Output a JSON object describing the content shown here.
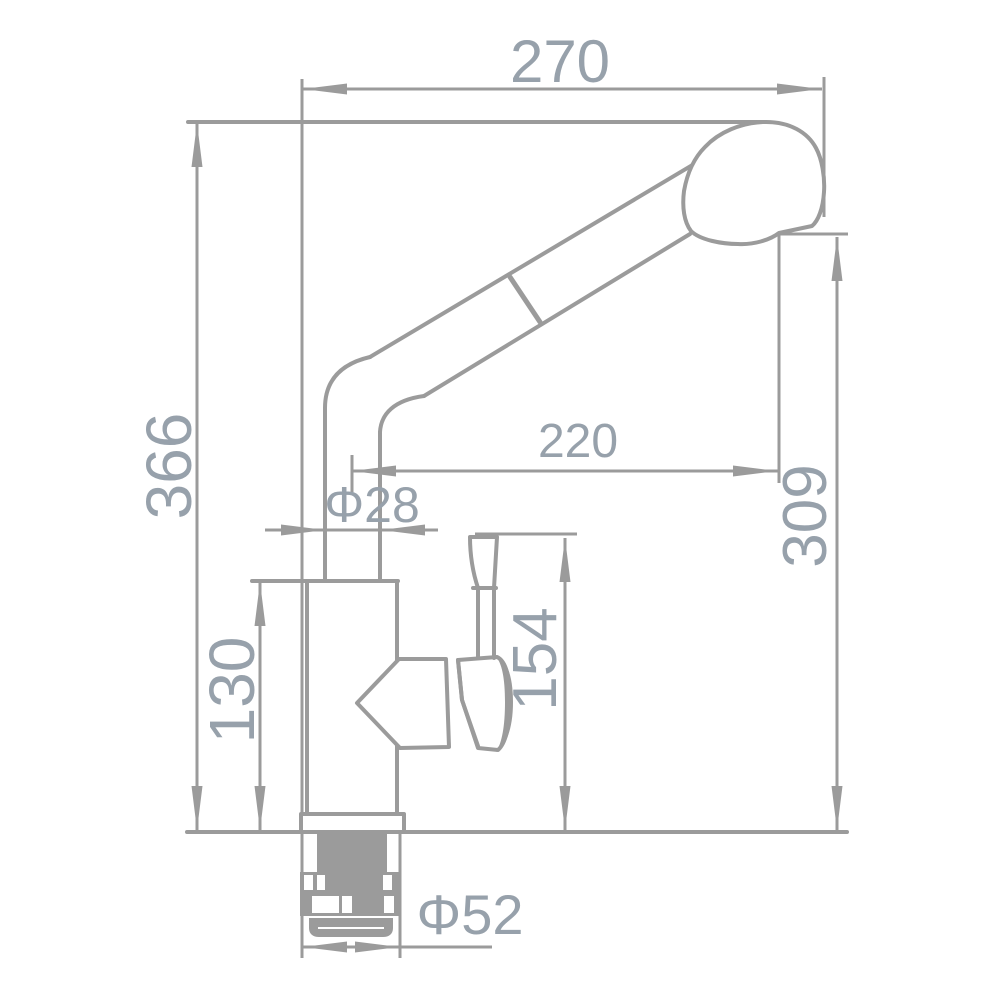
{
  "drawing": {
    "type": "faucet-dimension-drawing",
    "background": "#ffffff",
    "line_color": "#9b9b9b",
    "label_color": "#97a1ab",
    "dimensions": {
      "top_width": "270",
      "overall_height": "366",
      "spout_reach": "220",
      "pipe_diameter": "Φ28",
      "outlet_height": "309",
      "handle_height": "154",
      "body_height": "130",
      "base_diameter": "Φ52"
    }
  }
}
